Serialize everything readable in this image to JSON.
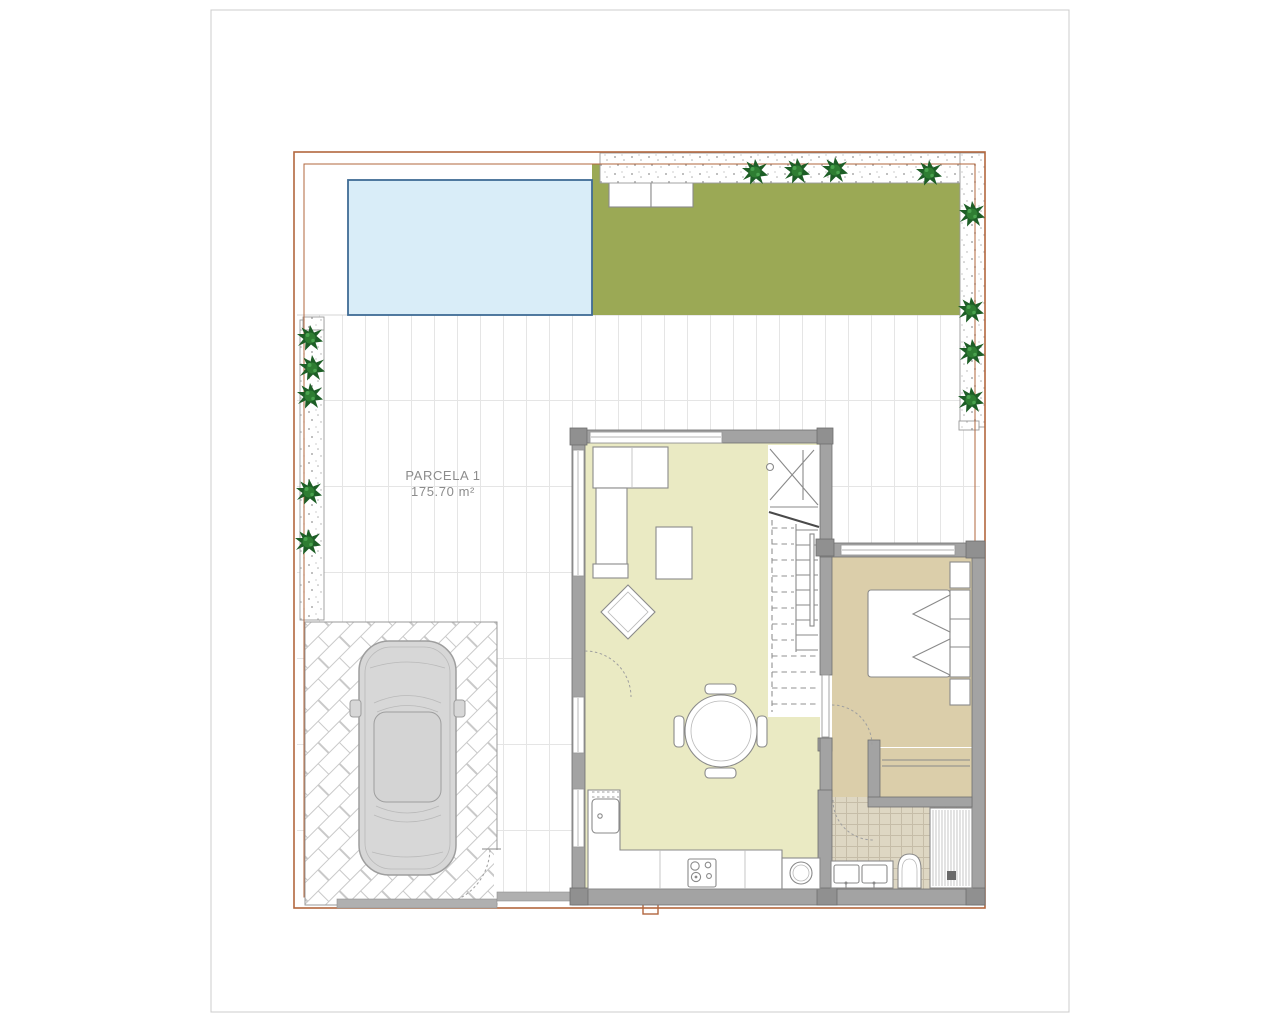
{
  "sheet": {
    "background": "#ffffff",
    "border_color": "#cccccc"
  },
  "plan": {
    "parcel_label": "PARCELA 1",
    "parcel_area": "175.70 m²"
  },
  "colors": {
    "plot_border": "#b2673e",
    "pool_fill": "#d9edf8",
    "pool_edge": "#3f6b95",
    "garden_green": "#9ba955",
    "tree_dark": "#1d5e26",
    "tree_mid": "#2e7d32",
    "tree_light": "#49a24e",
    "living_floor": "#eaeac3",
    "bedroom_floor": "#dbceaa",
    "bath_tile": "#ded7c3",
    "bath_tile_line": "#c6bda8",
    "wall_fill": "#a3a3a3",
    "wall_edge": "#6e6e6e",
    "pillar_fill": "#909090",
    "furniture_line": "#8a8a8a",
    "window_line": "#9a9a9a",
    "car_body": "#d7d7d7",
    "car_line": "#9e9e9e",
    "tile_line": "#e5e5e5",
    "herringbone_line": "#c9c9c9",
    "gravel_dot": "#8f8f8f",
    "label_text": "#8c8c8c",
    "stair_cut": "#4a4a4a",
    "threshold_gray": "#b0b0b0"
  },
  "features": {
    "outdoor": [
      "swimming-pool",
      "garden-lawn",
      "garden-storage-boxes",
      "gravel-border",
      "planter-trees",
      "paved-terrace",
      "parking-herringbone",
      "car",
      "pedestrian-gate",
      "plot-boundary"
    ],
    "indoor": [
      "living-dining-room",
      "open-kitchen",
      "staircase",
      "bedroom",
      "bathroom"
    ],
    "furniture": [
      "corner-sofa",
      "coffee-table",
      "armchair",
      "dining-table-4-chairs",
      "kitchen-sink",
      "hob",
      "washing-machine",
      "double-bed",
      "nightstands",
      "wardrobe",
      "double-washbasin",
      "toilet",
      "shower"
    ]
  }
}
